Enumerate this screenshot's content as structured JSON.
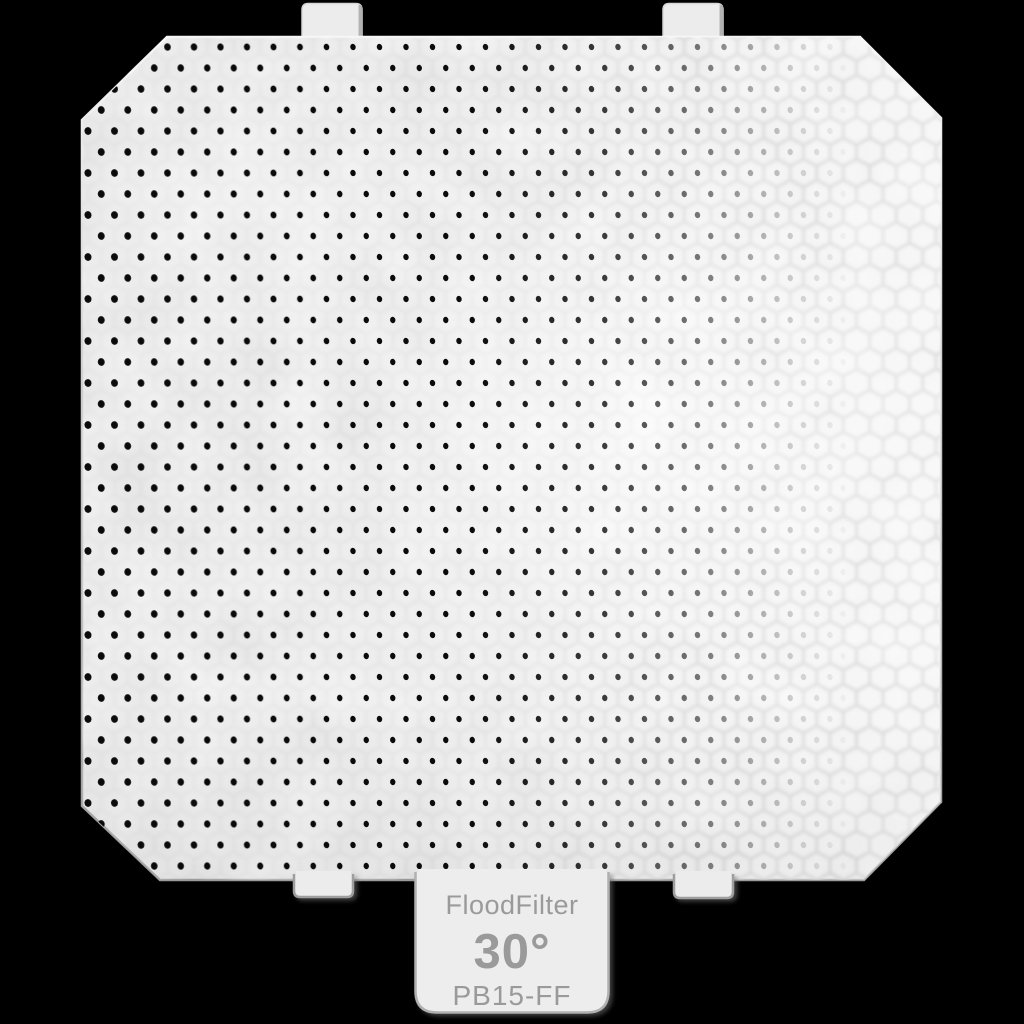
{
  "product_image": {
    "description": "honeycomb flood filter accessory on black background",
    "label_tab": {
      "product_name": "FloodFilter",
      "beam_angle": "30°",
      "model_number": "PB15-FF",
      "text_color": "#9a9a9a",
      "background_color": "#ededed"
    },
    "filter": {
      "body_color": "#eaeaea",
      "dot_color": "#0b0b0b",
      "cell_wall_color": "#c9c9c9",
      "edge_dark_color": "#9b9b9b",
      "texture": "honeycomb-grid"
    },
    "scene": {
      "background_color": "#000000"
    }
  }
}
